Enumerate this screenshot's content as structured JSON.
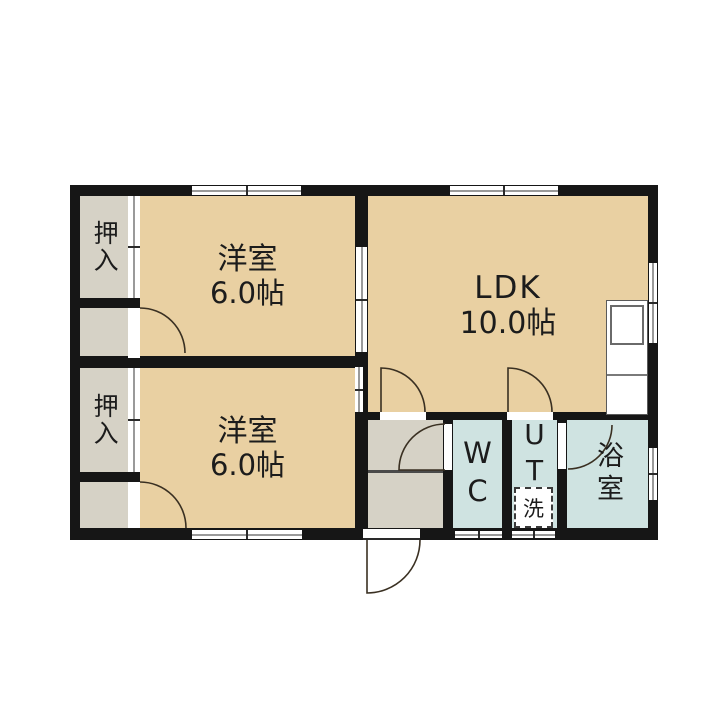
{
  "plan": {
    "bedroom1": {
      "name": "洋室",
      "size": "6.0帖"
    },
    "bedroom2": {
      "name": "洋室",
      "size": "6.0帖"
    },
    "ldk": {
      "name": "LDK",
      "size": "10.0帖"
    },
    "closet1": {
      "name": "押入"
    },
    "closet2": {
      "name": "押入"
    },
    "wc": {
      "name": "WC"
    },
    "ut": {
      "name": "UT"
    },
    "bath": {
      "name": "浴室"
    },
    "washer": {
      "name": "洗"
    }
  },
  "colors": {
    "room_floor": "#e9d0a2",
    "closet_floor": "#d6d2c6",
    "wet_area_floor": "#cfe3e1",
    "wall": "#161616"
  }
}
